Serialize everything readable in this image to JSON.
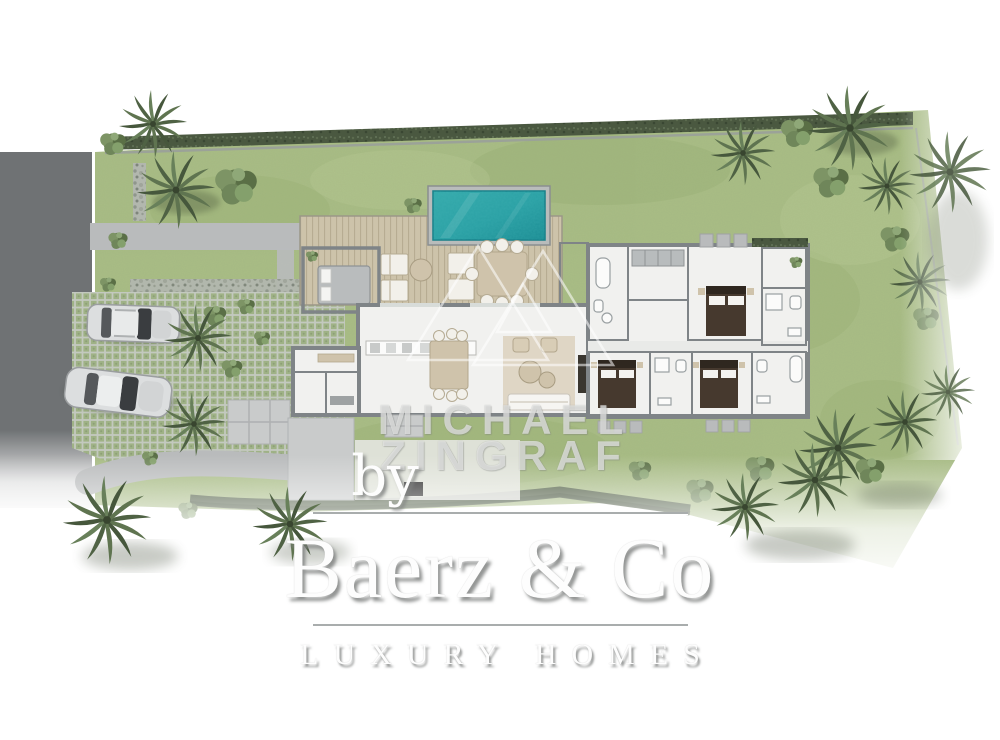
{
  "branding": {
    "watermark_line1": "MICHAEL",
    "watermark_line2": "ZINGRAF",
    "by_label": "by",
    "logo_name": "Baerz & Co",
    "logo_tagline": "LUXURY HOMES"
  },
  "plan": {
    "description": "Top-view landscaped site plan of a single-storey villa",
    "features": [
      "access-road",
      "driveway",
      "grass-paver-parking",
      "two-parked-cars",
      "swimming-pool",
      "timber-pool-deck",
      "outdoor-lounge",
      "outdoor-dining",
      "living-wing",
      "kitchen-annex",
      "bedroom-wing",
      "bathrooms",
      "lawn",
      "palm-trees",
      "hedges"
    ]
  },
  "colors": {
    "page_bg": "#ffffff",
    "road": "#6f7274",
    "path": "#b9bbbc",
    "patio": "#c9cbcb",
    "lawn": "#a9bd85",
    "lawn_shade": "#99b074",
    "hedge": "#4a5840",
    "paver_green": "#9fb286",
    "paver_grout": "#c3c9bf",
    "deck_wood": "#cdc3aa",
    "deck_line": "#b7ac92",
    "pool_water": "#2aa0a4",
    "pool_deep": "#17858d",
    "wall": "#7f8487",
    "floor": "#f1f1ef",
    "furniture_tan": "#cfc3ab",
    "bed_dark": "#46392e",
    "car_body": "#dcdedf",
    "palm_green": "#4f6244",
    "bush_green": "#667c50",
    "logo_text": "#fdfdfd",
    "logo_shadow": "rgba(128,131,129,0.85)",
    "divider": "#a9adad",
    "watermark": "rgba(255,255,255,0.58)"
  }
}
